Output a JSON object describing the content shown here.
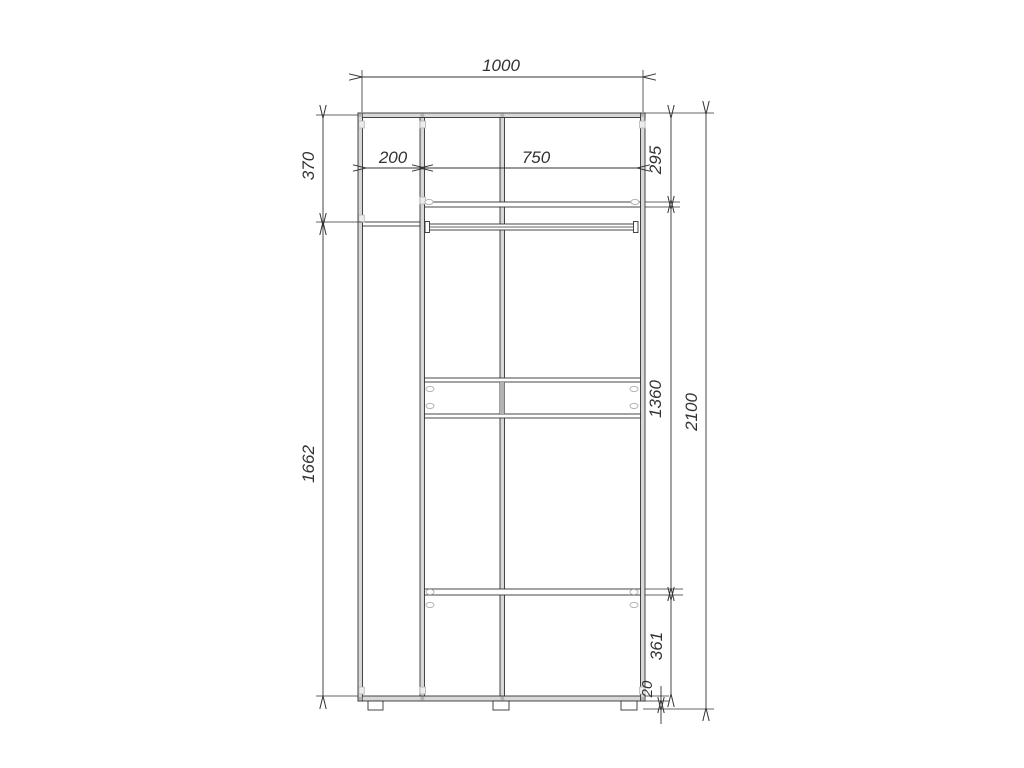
{
  "colors": {
    "line": "#333333",
    "panel_fill": "#d8d8d8",
    "connector": "#b3b3b3",
    "connector_fill": "#ececec",
    "background": "#ffffff"
  },
  "drawing": {
    "dims": {
      "total_width": "1000",
      "left_section_width": "200",
      "right_section_width": "750",
      "upper_left_height": "370",
      "lower_left_height": "1662",
      "upper_right_height": "295",
      "middle_right_height": "1360",
      "lower_right_height": "361",
      "plinth_height": "20",
      "total_height": "2100"
    }
  }
}
